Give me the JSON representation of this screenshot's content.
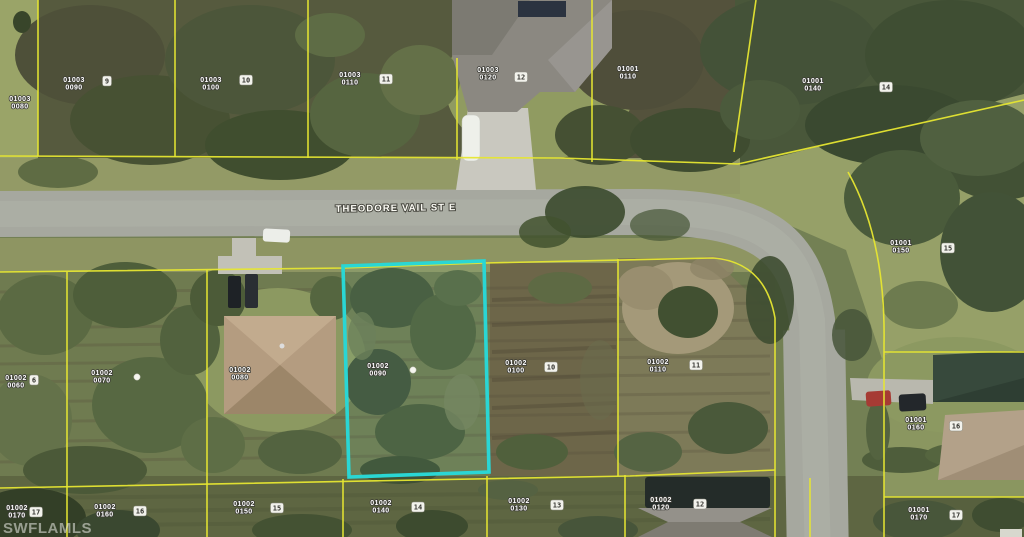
{
  "map": {
    "street_label": "THEODORE VAIL ST E",
    "watermark": "SWFLAMLS",
    "colors": {
      "highlight": "#2ad6d4",
      "parcel_line": "#e6e632"
    },
    "highlighted_parcel": {
      "block": "01002",
      "lot": "0090"
    },
    "parcel_labels": [
      {
        "block": "01003",
        "lot": "0080",
        "x": 20,
        "y": 101
      },
      {
        "block": "01003",
        "lot": "0090",
        "x": 74,
        "y": 82
      },
      {
        "block": "01003",
        "lot": "0100",
        "x": 211,
        "y": 82
      },
      {
        "block": "01003",
        "lot": "0110",
        "x": 350,
        "y": 77
      },
      {
        "block": "01003",
        "lot": "0120",
        "x": 488,
        "y": 72
      },
      {
        "block": "01001",
        "lot": "0110",
        "x": 628,
        "y": 71
      },
      {
        "block": "01001",
        "lot": "0140",
        "x": 813,
        "y": 83
      },
      {
        "block": "01001",
        "lot": "0150",
        "x": 901,
        "y": 245
      },
      {
        "block": "01001",
        "lot": "0160",
        "x": 916,
        "y": 422
      },
      {
        "block": "01001",
        "lot": "0170",
        "x": 919,
        "y": 512
      },
      {
        "block": "01002",
        "lot": "0060",
        "x": 16,
        "y": 380
      },
      {
        "block": "01002",
        "lot": "0070",
        "x": 102,
        "y": 375
      },
      {
        "block": "01002",
        "lot": "0080",
        "x": 240,
        "y": 372
      },
      {
        "block": "01002",
        "lot": "0090",
        "x": 378,
        "y": 368
      },
      {
        "block": "01002",
        "lot": "0100",
        "x": 516,
        "y": 365
      },
      {
        "block": "01002",
        "lot": "0110",
        "x": 658,
        "y": 364
      },
      {
        "block": "01002",
        "lot": "0170",
        "x": 17,
        "y": 510
      },
      {
        "block": "01002",
        "lot": "0160",
        "x": 105,
        "y": 509
      },
      {
        "block": "01002",
        "lot": "0150",
        "x": 244,
        "y": 506
      },
      {
        "block": "01002",
        "lot": "0140",
        "x": 381,
        "y": 505
      },
      {
        "block": "01002",
        "lot": "0130",
        "x": 519,
        "y": 503
      },
      {
        "block": "01002",
        "lot": "0120",
        "x": 661,
        "y": 502
      }
    ],
    "lot_markers": [
      {
        "label": "9",
        "x": 107,
        "y": 81
      },
      {
        "label": "10",
        "x": 246,
        "y": 80
      },
      {
        "label": "11",
        "x": 386,
        "y": 79
      },
      {
        "label": "12",
        "x": 521,
        "y": 77
      },
      {
        "label": "14",
        "x": 886,
        "y": 87
      },
      {
        "label": "15",
        "x": 948,
        "y": 248
      },
      {
        "label": "16",
        "x": 956,
        "y": 426
      },
      {
        "label": "17",
        "x": 956,
        "y": 515
      },
      {
        "label": "6",
        "x": 34,
        "y": 380
      },
      {
        "label": "10",
        "x": 551,
        "y": 367
      },
      {
        "label": "11",
        "x": 696,
        "y": 365
      },
      {
        "label": "17",
        "x": 36,
        "y": 512
      },
      {
        "label": "16",
        "x": 140,
        "y": 511
      },
      {
        "label": "15",
        "x": 277,
        "y": 508
      },
      {
        "label": "14",
        "x": 418,
        "y": 507
      },
      {
        "label": "13",
        "x": 557,
        "y": 505
      },
      {
        "label": "12",
        "x": 700,
        "y": 504
      }
    ],
    "survey_dots": [
      {
        "x": 413,
        "y": 370
      },
      {
        "x": 137,
        "y": 377
      }
    ]
  }
}
